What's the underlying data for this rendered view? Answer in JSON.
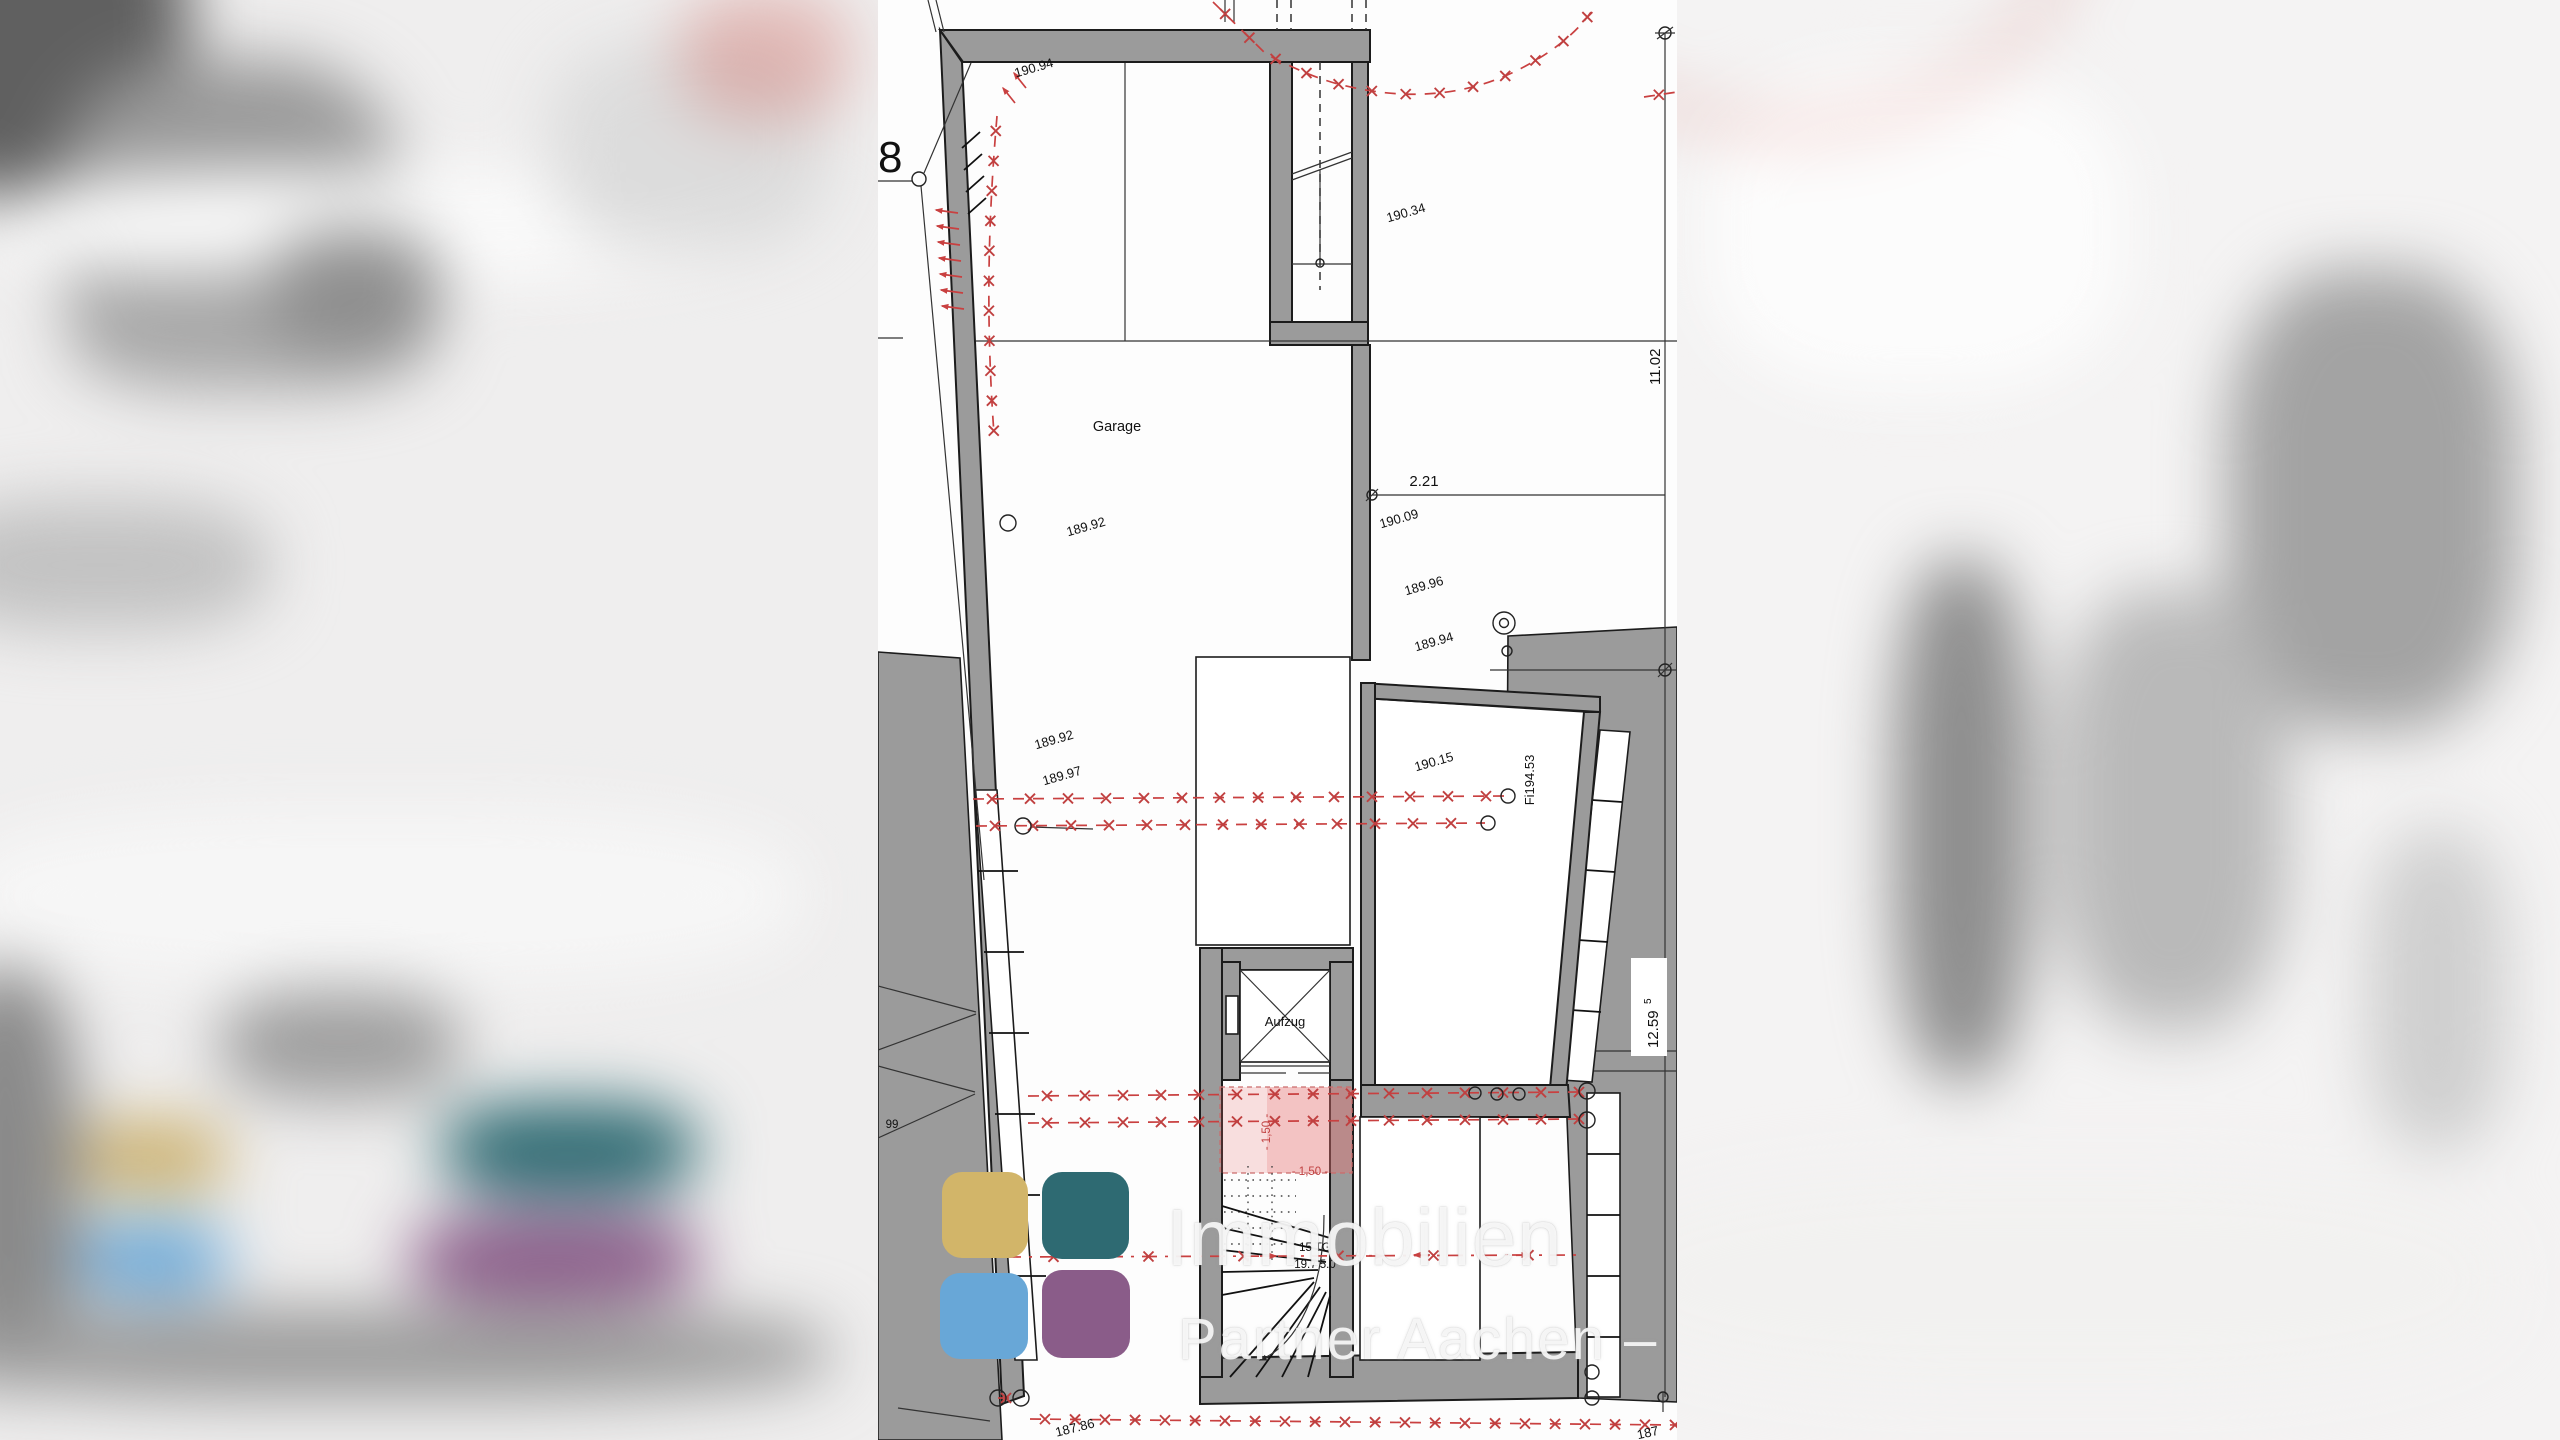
{
  "colors": {
    "wall_gray": "#9b9b9b",
    "survey_red": "#c94040",
    "pink_fill": "#f5dada",
    "logo_yellow": "#d2b569",
    "logo_teal": "#2e6a72",
    "logo_blue": "#68a7d7",
    "logo_purple": "#8a5c89"
  },
  "watermark": {
    "line1": "Immobilien",
    "line2": "Partner Aachen – IPA"
  },
  "rooms": {
    "garage": "Garage",
    "elevator": "Aufzug"
  },
  "levels": {
    "top": "190.94",
    "upper_court": "190.34",
    "garage": "189.92",
    "left_upper": "189.92",
    "left_lower": "189.97",
    "court_1": "190.09",
    "court_2": "189.96",
    "court_3": "189.94",
    "room_right": "190.15",
    "bottom": "187.86",
    "bottom_right_partial": "187"
  },
  "dimensions": {
    "right_upper": "11.02",
    "garage_to_boundary": "2.21",
    "right_lower_main": "12.59",
    "right_lower_sup": "5",
    "pink_vertical": "- 1,50 -",
    "pink_horizontal": "- 1,50 -"
  },
  "stairs": {
    "line1": "15 TG",
    "line2": "19.7  5.0"
  },
  "site": {
    "house_number": "8",
    "left_partial": "99",
    "fixpoint": "Fi194.53"
  }
}
